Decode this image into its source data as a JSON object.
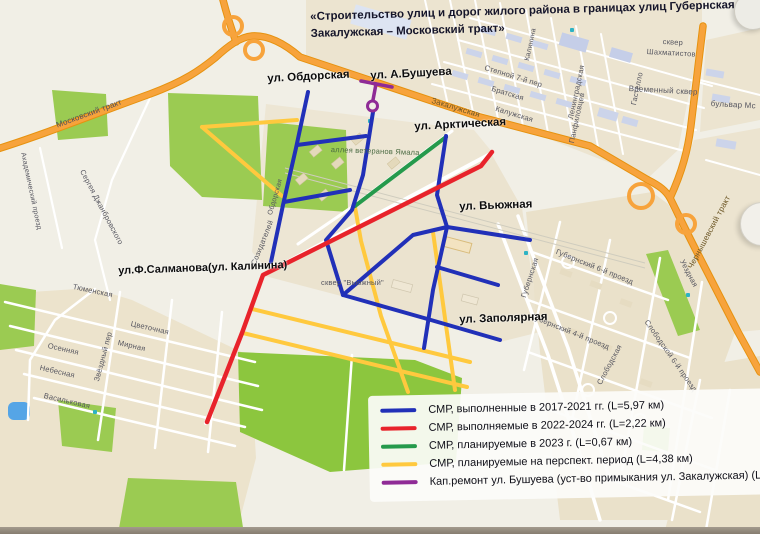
{
  "title": "«Строительство улиц и дорог жилого района в границах улиц Губернская – Закалужская – Московский тракт»",
  "annotations": {
    "obdorskaya": "ул. Обдорская",
    "bushueva": "ул. А.Бушуева",
    "arkticheskaya": "ул. Арктическая",
    "vyuzhnaya": "ул. Вьюжная",
    "salmanova": "ул.Ф.Салманова(ул. Калинина)",
    "zapolyarnaya": "ул. Заполярная"
  },
  "legend": {
    "items": [
      {
        "color": "#2130b8",
        "label": "СМР, выполненные в 2017-2021 гг. (L=5,97 км)"
      },
      {
        "color": "#e8232b",
        "label": "СМР, выполняемые в 2022-2024 гг. (L=2,22 км)"
      },
      {
        "color": "#259a4c",
        "label": "СМР, планируемые в 2023 г. (L=0,67 км)"
      },
      {
        "color": "#ffc93e",
        "label": "СМР, планируемые на перспект. период (L=4,38 км)"
      },
      {
        "color": "#8f2b96",
        "label": "Кап.ремонт ул. Бушуева (уст-во примыкания ул. Закалужская) (L=1,06 км)"
      }
    ]
  },
  "routes": {
    "completed": "#2130b8",
    "current": "#e8232b",
    "planned2023": "#259a4c",
    "perspective": "#ffc93e",
    "capremont": "#8f2b96"
  },
  "palette": {
    "highway": "#f7a33c",
    "park": "#9bcb52",
    "big_park": "#8cc63e",
    "water": "#55a5e6",
    "block": "#ece4d0"
  },
  "map_labels": [
    {
      "t": "Московский тракт",
      "x": 55,
      "y": 121,
      "r": -20,
      "s": 8,
      "c": "#4e4e58"
    },
    {
      "t": "Закалужская",
      "x": 433,
      "y": 96,
      "r": 17,
      "s": 8,
      "c": "#6b5524"
    },
    {
      "t": "Калужская",
      "x": 497,
      "y": 104,
      "r": 17,
      "s": 7.5
    },
    {
      "t": "Братская",
      "x": 493,
      "y": 84,
      "r": 17,
      "s": 7.5
    },
    {
      "t": "Степной 7-й пер",
      "x": 486,
      "y": 63,
      "r": 17,
      "s": 7.5
    },
    {
      "t": "сквер",
      "x": 663,
      "y": 37,
      "r": 3,
      "s": 7.5
    },
    {
      "t": "Шахматистов",
      "x": 647,
      "y": 47,
      "r": 3,
      "s": 7.5
    },
    {
      "t": "Временный сквер",
      "x": 629,
      "y": 84,
      "r": 3,
      "s": 8
    },
    {
      "t": "бульвар Мс",
      "x": 711,
      "y": 99,
      "r": 3,
      "s": 8
    },
    {
      "t": "Ленинградская",
      "x": 566,
      "y": 118,
      "r": -78,
      "s": 7.5
    },
    {
      "t": "Гастелло",
      "x": 629,
      "y": 104,
      "r": -78,
      "s": 7.5
    },
    {
      "t": "Панфиловцев",
      "x": 567,
      "y": 142,
      "r": -78,
      "s": 7.5
    },
    {
      "t": "Калинина",
      "x": 524,
      "y": 60,
      "r": -78,
      "s": 7
    },
    {
      "t": "Чернышевский тракт",
      "x": 686,
      "y": 266,
      "r": -62,
      "s": 8,
      "c": "#6b5524"
    },
    {
      "t": "Губернская",
      "x": 519,
      "y": 296,
      "r": -72,
      "s": 7.5
    },
    {
      "t": "Губернский 6-й проезд",
      "x": 558,
      "y": 247,
      "r": 22,
      "s": 7.5
    },
    {
      "t": "Губернский 4-й проезд",
      "x": 534,
      "y": 312,
      "r": 22,
      "s": 7.5
    },
    {
      "t": "Слободская",
      "x": 595,
      "y": 382,
      "r": -62,
      "s": 7.5
    },
    {
      "t": "Слободской 6-й проезд",
      "x": 650,
      "y": 318,
      "r": 55,
      "s": 7.5
    },
    {
      "t": "Уездная",
      "x": 686,
      "y": 258,
      "r": 62,
      "s": 7.5
    },
    {
      "t": "аллея ветеранов Ямала",
      "x": 331,
      "y": 145,
      "r": 2,
      "s": 7.5,
      "c": "#4a6a42"
    },
    {
      "t": "сквер \"Вьюжный\"",
      "x": 321,
      "y": 278,
      "r": 0,
      "s": 7.5
    },
    {
      "t": "Созидателей",
      "x": 249,
      "y": 263,
      "r": -68,
      "s": 7.5
    },
    {
      "t": "Цветочная",
      "x": 132,
      "y": 319,
      "r": 13,
      "s": 7.5
    },
    {
      "t": "Мирная",
      "x": 119,
      "y": 338,
      "r": 13,
      "s": 7.5
    },
    {
      "t": "Осенняя",
      "x": 49,
      "y": 341,
      "r": 13,
      "s": 7.5
    },
    {
      "t": "Небесная",
      "x": 41,
      "y": 363,
      "r": 13,
      "s": 7.5
    },
    {
      "t": "Васильковая",
      "x": 45,
      "y": 391,
      "r": 13,
      "s": 7.5
    },
    {
      "t": "Звёздный пер",
      "x": 92,
      "y": 380,
      "r": -75,
      "s": 7.5
    },
    {
      "t": "Сергея Джанбровского",
      "x": 86,
      "y": 168,
      "r": 62,
      "s": 7.5
    },
    {
      "t": "Академический проезд",
      "x": 26,
      "y": 152,
      "r": 78,
      "s": 7
    },
    {
      "t": "Тюменская",
      "x": 74,
      "y": 282,
      "r": 12,
      "s": 7.5
    },
    {
      "t": "Обдорская",
      "x": 267,
      "y": 214,
      "r": -74,
      "s": 7
    }
  ]
}
